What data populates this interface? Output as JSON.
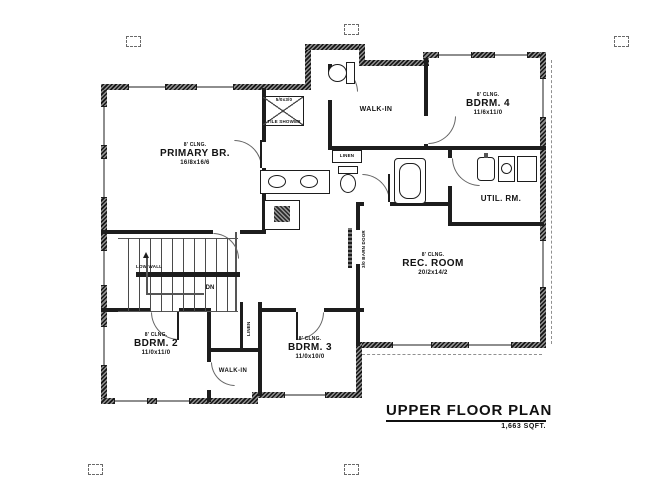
{
  "sheet": {
    "title": "UPPER FLOOR PLAN",
    "area": "1,663 SQFT."
  },
  "rooms": {
    "primary": {
      "clng": "8' CLNG.",
      "name": "PRIMARY BR.",
      "dims": "16/8x16/6"
    },
    "bdrm4": {
      "clng": "8' CLNG.",
      "name": "BDRM. 4",
      "dims": "11/6x11/0"
    },
    "bdrm2": {
      "clng": "8' CLNG.",
      "name": "BDRM. 2",
      "dims": "11/0x11/0"
    },
    "bdrm3": {
      "clng": "8' CLNG.",
      "name": "BDRM. 3",
      "dims": "11/0x10/0"
    },
    "rec": {
      "clng": "8' CLNG.",
      "name": "REC. ROOM",
      "dims": "20/2x14/2"
    },
    "walkin_top": {
      "name": "WALK-IN"
    },
    "walkin_bottom": {
      "name": "WALK-IN"
    },
    "util": {
      "name": "UTIL. RM."
    },
    "linen_mid": {
      "name": "LINEN"
    },
    "linen_bottom": {
      "name": "LINEN"
    }
  },
  "annotations": {
    "dn": "DN",
    "low_wall": "LOW WALL",
    "barn_door": "3/0 BARN DOOR",
    "shower_dims": "5/0x3/0",
    "shower_name": "TILE SHOWER"
  },
  "colors": {
    "ink": "#1d1d1d",
    "paper": "#ffffff"
  }
}
